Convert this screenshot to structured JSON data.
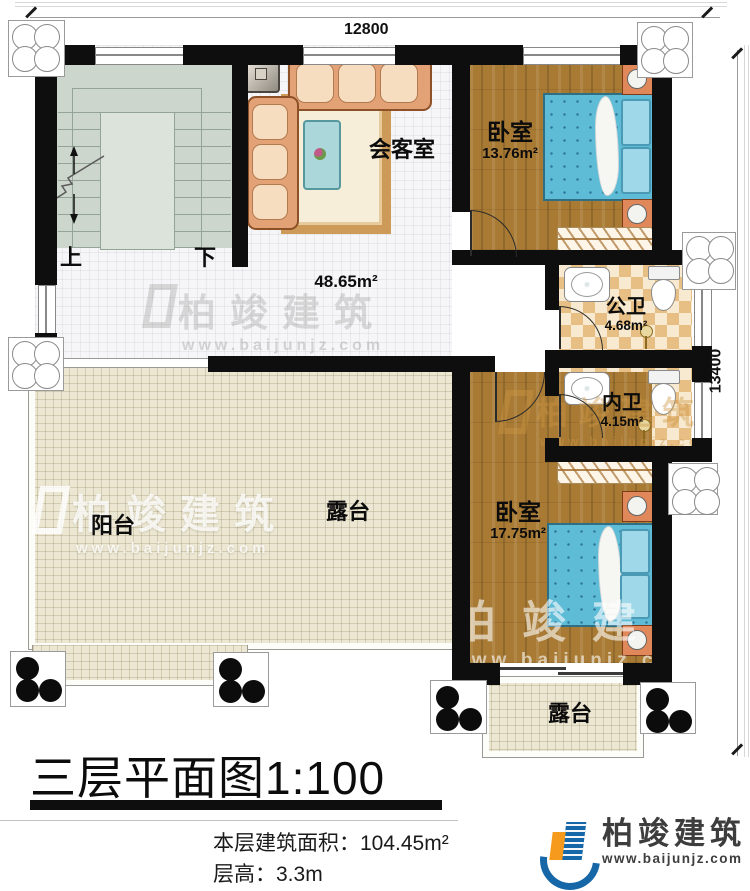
{
  "dimensions": {
    "top": "12800",
    "right": "13400"
  },
  "stairs": {
    "up": "上",
    "down": "下"
  },
  "hall": {
    "meeting_label": "会客室",
    "area": "48.65m²"
  },
  "rooms": {
    "bedroom_top": {
      "name": "卧室",
      "area": "13.76m²"
    },
    "public_bath": {
      "name": "公卫",
      "area": "4.68m²"
    },
    "private_bath": {
      "name": "内卫",
      "area": "4.15m²"
    },
    "bedroom_bottom": {
      "name": "卧室",
      "area": "17.75m²"
    },
    "balcony": {
      "name": "阳台"
    },
    "terrace_main": {
      "name": "露台"
    },
    "terrace_small": {
      "name": "露台"
    }
  },
  "title_block": {
    "title": "三层平面图1:100",
    "area_line": "本层建筑面积：104.45m²",
    "height_line": "层高：3.3m"
  },
  "brand": {
    "name": "柏竣建筑",
    "website": "www.baijunjz.com"
  },
  "watermark": {
    "name": "柏竣建筑",
    "website": "www.baijunjz.com"
  },
  "colors": {
    "wall": "#0e0e0e",
    "wood": "#a87a33",
    "bath_tile": "#e7bf85",
    "terrace": "#ece7d3",
    "stair": "#ccd6cc",
    "bed": "#5fbcd6",
    "logo_blue": "#1667a8",
    "logo_orange": "#f59a1d"
  }
}
